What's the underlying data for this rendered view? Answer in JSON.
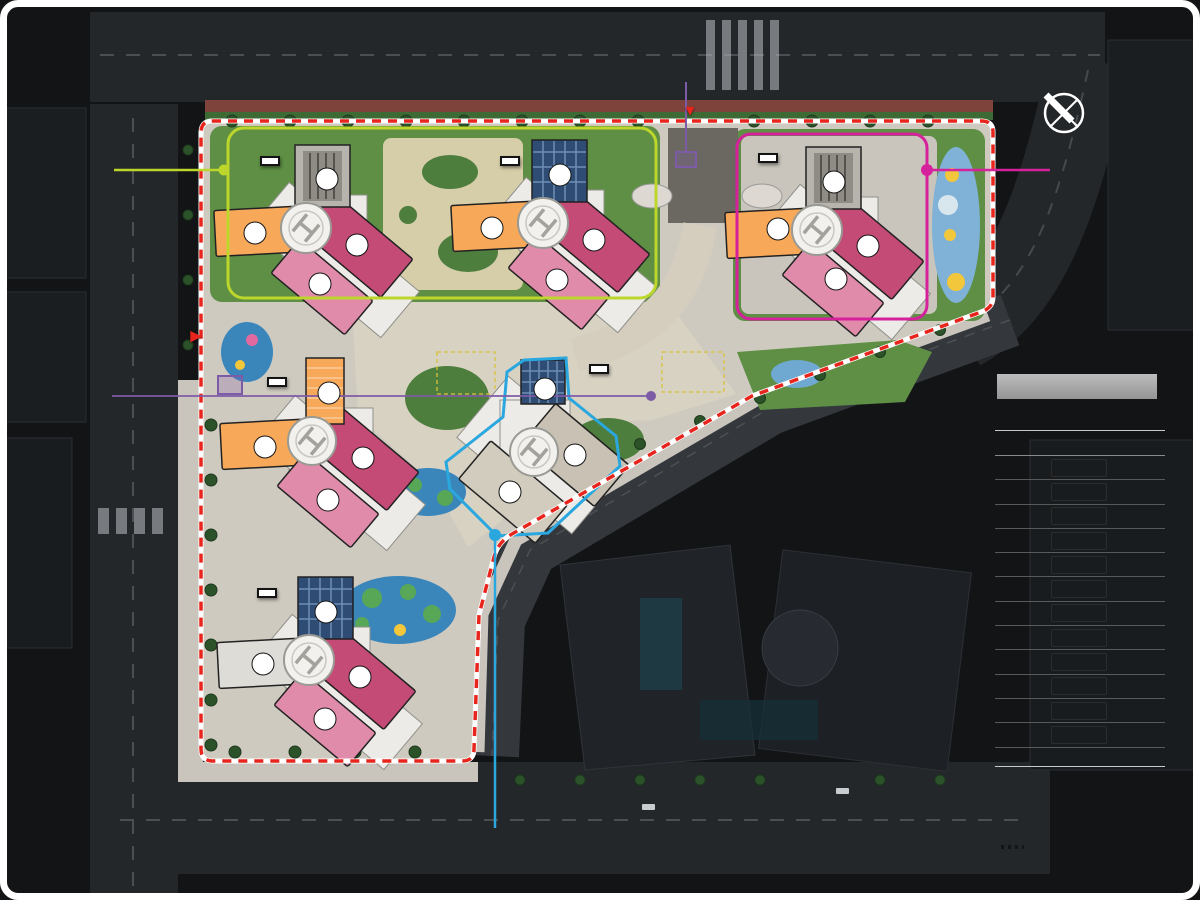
{
  "units": [
    "1",
    "2",
    "3",
    "4"
  ],
  "compass": {
    "n": "N"
  },
  "roads": {
    "top": "22.2m 도로",
    "right": "33.3m 도로",
    "left": "26.4m 도로",
    "bottom": "31m 도로",
    "inner": "16m 도로"
  },
  "entrances": {
    "main": "주출입구",
    "main_sub": "(주거 / 비주거)",
    "side": "부출입구",
    "side_sub": "(주거)",
    "guard_top": "경비실",
    "guard_left": "경비실"
  },
  "buildings": {
    "b301": "301동",
    "b302": "302동",
    "b303": "303동",
    "b304": "304동",
    "b305": "305동",
    "b306": "306동"
  },
  "map_labels": {
    "vital_garden": "바이탈가든",
    "wellness_lounge": "웰니스라운지",
    "kids_station": "키즈스테이션",
    "play3": "어린이놀이터3",
    "play3_sub": "(몽실몽실 파란구름)",
    "public_walk": "공공보행통로",
    "central_lounge": "센트럴라운지",
    "kids_bus": "어린이버스 승하차장",
    "play2": "어린이놀이터2",
    "play2_sub": "(씰룩씰룩 노랑정원)",
    "infant_play": "유아놀이터",
    "infant_play_sub": "(꼬물꼬물 하늘이 집)",
    "open_lounge": "오픈라운지",
    "open_lounge_sub": "(공개공지)",
    "play4": "어린이놀이터4",
    "play4_sub": "(몽실몽실 파란구름)",
    "play1": "어린이놀이터1",
    "play1_sub": "(싱글벙글 초록 산)"
  },
  "lists": {
    "left": [
      "- 퍼스널 GX",
      "- GX룸",
      "- 실내체육관 / 러닝트랙",
      "- 실내골프연습장",
      "- 피트니스",
      "- 퍼스널스파",
      "- 스카이라운지",
      "- 키즈스테이션",
      "- 관리사무소"
    ],
    "right": [
      "- 어린이집",
      "- 경로당",
      "- 게스트하우스",
      "- 파티룸",
      "- 다함께돌봄센터",
      "- 작은도서관"
    ],
    "bottom": [
      "- 그린라운지(코워킹라운지)",
      "- 개인독서실",
      "- 공동체커뮤니티",
      "- 무비살롱",
      "- 클래스라운지",
      "- 회의실"
    ]
  },
  "legend": {
    "title": "범례",
    "subtitle": "총 998세대 中 1회차 657세대",
    "col_type": "주택형",
    "col_count": "세대 수",
    "rows": [
      {
        "type": "84A",
        "color": "#F7A859",
        "count": "223세대"
      },
      {
        "type": "84B",
        "color": "#E18BAB",
        "count": "217세대"
      },
      {
        "type": "84C",
        "color": "#C34B76",
        "count": "217세대"
      },
      {
        "type": "105A",
        "color": "#ABABAB",
        "count": "128세대"
      },
      {
        "type": "105B",
        "color": "#ABABAB",
        "count": "64세대"
      },
      {
        "type": "105C1T",
        "color": "#ABABAB",
        "count": "15세대"
      },
      {
        "type": "105C2T",
        "color": "#ABABAB",
        "count": "29세대"
      },
      {
        "type": "105D",
        "color": "#ABABAB",
        "count": "44세대"
      },
      {
        "type": "105E",
        "color": "#ABABAB",
        "count": "44세대"
      },
      {
        "type": "119A1T",
        "color": "#ABABAB",
        "count": "6세대"
      },
      {
        "type": "119A2T",
        "color": "#ABABAB",
        "count": "5세대"
      },
      {
        "type": "119A3T",
        "color": "#ABABAB",
        "count": "6세대"
      }
    ],
    "total": "총 998세대",
    "lines": [
      {
        "label": "301동 커뮤니티센터",
        "color": "#D6219C",
        "style": "solid"
      },
      {
        "label": "302동 커뮤니티센터",
        "color": "#2AA7DF",
        "style": "solid"
      },
      {
        "label": "305 / 306동 커뮤니티센터",
        "color": "#BDD62C",
        "style": "solid"
      },
      {
        "label": "대지경계선",
        "color": "#E8251D",
        "style": "dashed"
      }
    ]
  }
}
